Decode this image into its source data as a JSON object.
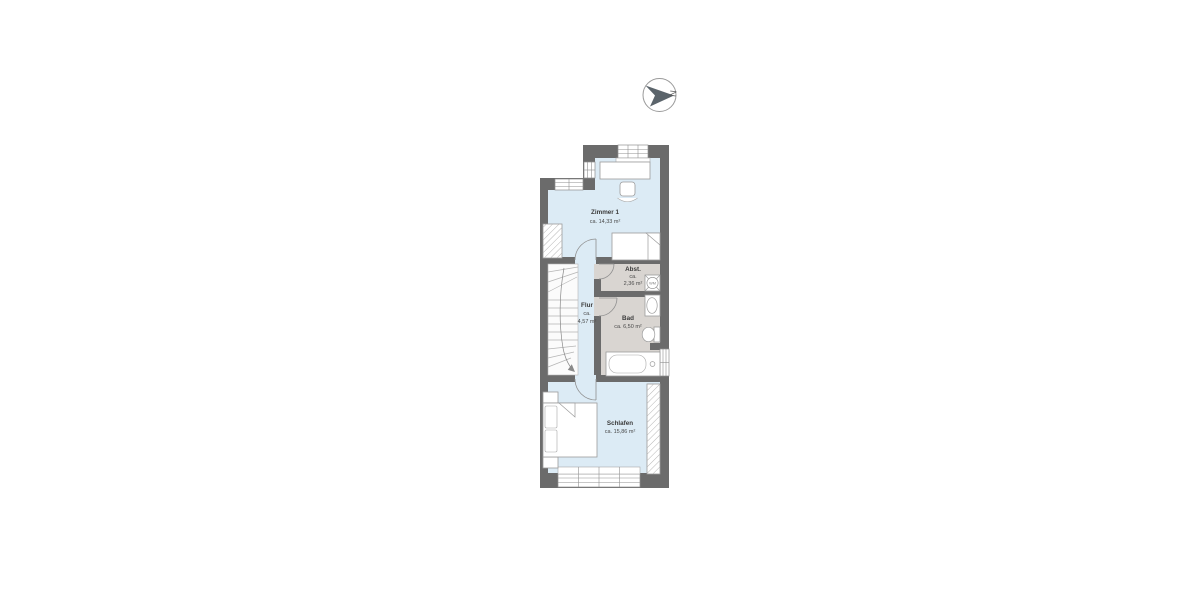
{
  "plan": {
    "type": "floorplan",
    "rooms": {
      "zimmer1": {
        "name": "Zimmer 1",
        "area": "ca. 14,33 m²"
      },
      "flur": {
        "name": "Flur",
        "approx": "ca.",
        "area": "4,57 m²"
      },
      "abstellraum": {
        "name": "Abst.",
        "approx": "ca.",
        "area": "2,36 m²"
      },
      "bad": {
        "name": "Bad",
        "area": "ca. 6,50 m²"
      },
      "schlafen": {
        "name": "Schlafen",
        "area": "ca. 15,86 m²"
      }
    },
    "appliances": {
      "washing_machine": {
        "label": "WM"
      }
    },
    "compass": {
      "label": "N"
    },
    "colors": {
      "wall": "#6b6b6b",
      "floor_rooms": "#dcebf5",
      "floor_bath": "#d9d5d1",
      "furniture_outline": "#9b9b9b",
      "compass_arrow": "#5b646b"
    }
  }
}
